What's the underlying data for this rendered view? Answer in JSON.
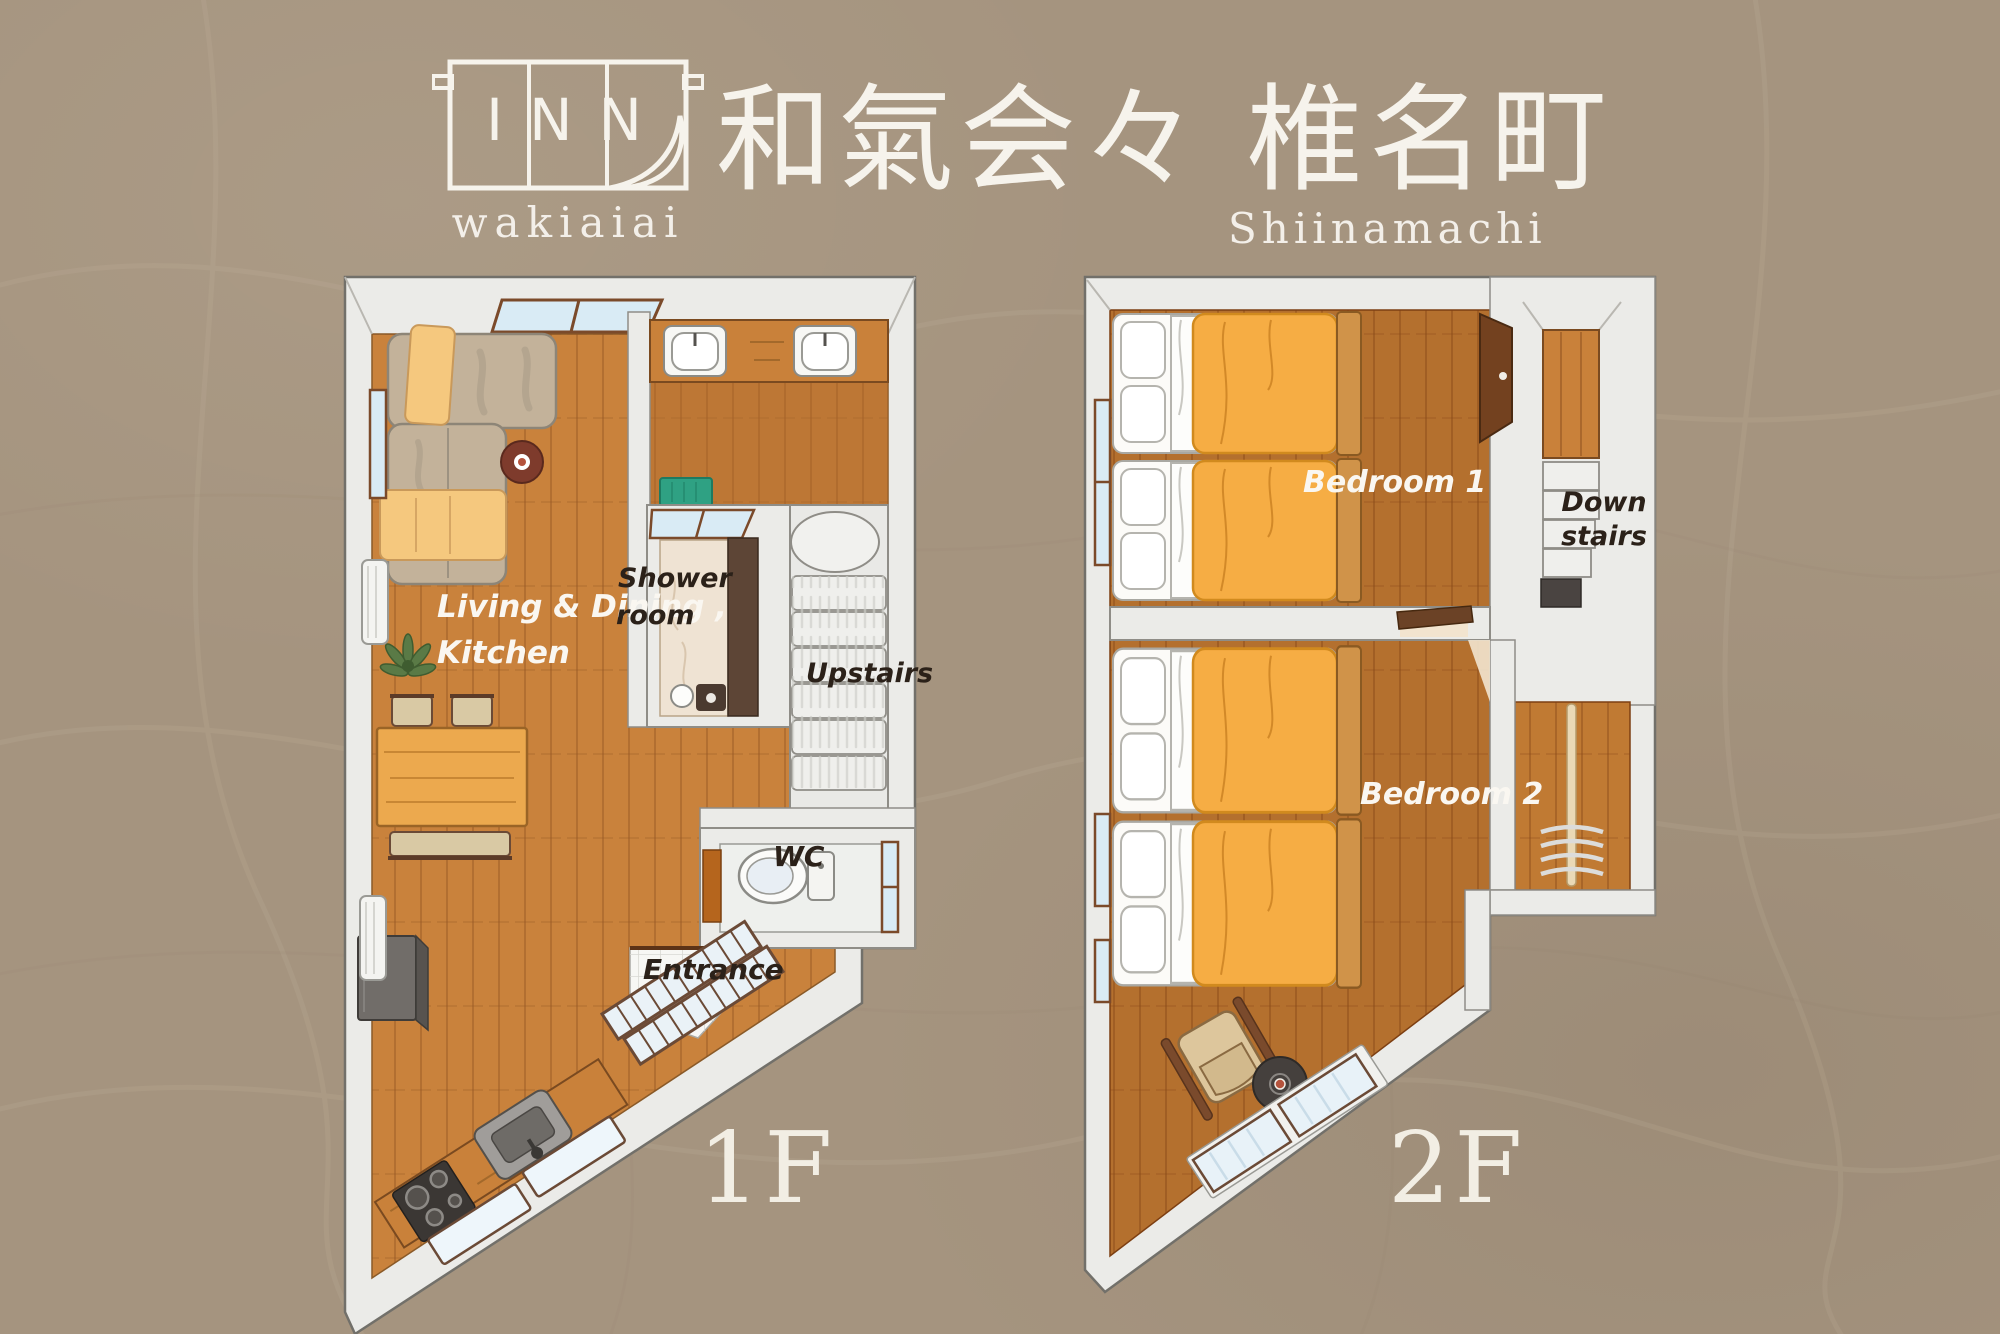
{
  "header": {
    "logo_text": "INN",
    "logo_subtext": "wakiaiai",
    "title_jp": "和氣会々 椎名町",
    "title_romaji": "Shiinamachi"
  },
  "floor1": {
    "floor_label": "1F",
    "rooms": {
      "living_dining_kitchen": {
        "label_line1": "Living & Dining ,",
        "label_line2": "Kitchen"
      },
      "shower_room": {
        "label_line1": "Shower",
        "label_line2": "room"
      },
      "upstairs": {
        "label": "Upstairs"
      },
      "wc": {
        "label": "WC"
      },
      "entrance": {
        "label": "Entrance"
      }
    }
  },
  "floor2": {
    "floor_label": "2F",
    "rooms": {
      "bedroom1": {
        "label": "Bedroom 1"
      },
      "bedroom2": {
        "label": "Bedroom 2"
      },
      "downstairs": {
        "label_line1": "Down",
        "label_line2": "stairs"
      }
    }
  },
  "colors": {
    "background": "#a5947f",
    "wall": "#ebebe8",
    "wood_floor": "#c9823c",
    "wood_floor_dark": "#b4702e",
    "duvet_orange": "#f6ad44",
    "blanket_yellow": "#f5c87e",
    "bath_mat_green": "#2fa183",
    "window_blue": "#d9ebf5",
    "text_light": "#f7f4ec",
    "text_dark": "#2b2119"
  }
}
